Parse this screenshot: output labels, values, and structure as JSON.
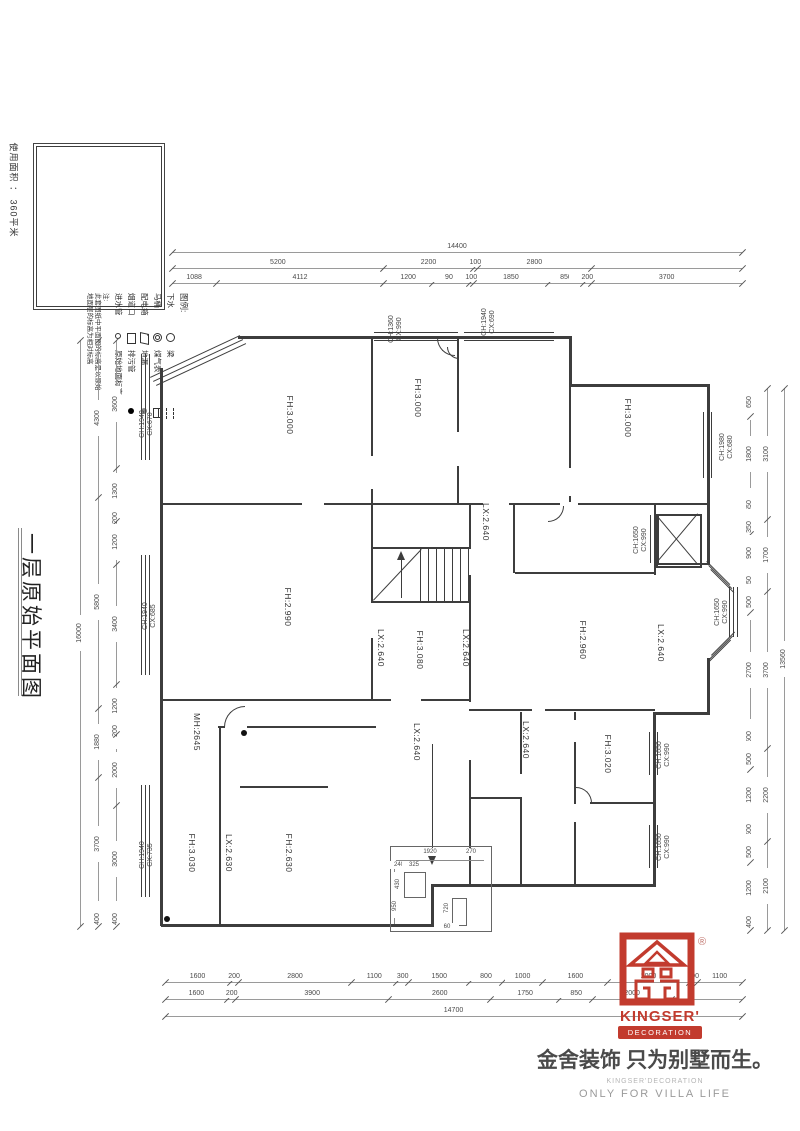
{
  "page": {
    "area_note": "使用面积 ： 360平米",
    "title_vertical": "一层原始平面图"
  },
  "legend": {
    "title": "图例:",
    "items": [
      {
        "label": "下水",
        "symbol": "circle"
      },
      {
        "label": "马桶",
        "symbol": "double-circle"
      },
      {
        "label": "配电箱",
        "symbol": "panel"
      },
      {
        "label": "烟道口",
        "symbol": "flue"
      },
      {
        "label": "进水管",
        "symbol": "small-circle"
      },
      {
        "label": "梁",
        "symbol": "beam"
      },
      {
        "label": "煤气表",
        "symbol": "gas-meter"
      },
      {
        "label": "地漏",
        "symbol": "floor-drain"
      },
      {
        "label": "排污管",
        "symbol": "sewage"
      },
      {
        "label": "原始地面标高",
        "symbol": "elevation"
      }
    ],
    "note_prefix": "注:",
    "note_lines": [
      "此套图纸中平面图的标高是以原始",
      "地面层的标高为相对标高"
    ]
  },
  "plan": {
    "room_labels": [
      {
        "t": "FH:3.000",
        "x": 290,
        "y": 415
      },
      {
        "t": "FH:3.000",
        "x": 418,
        "y": 398
      },
      {
        "t": "FH:3.000",
        "x": 628,
        "y": 418
      },
      {
        "t": "FH:2.990",
        "x": 288,
        "y": 607
      },
      {
        "t": "FH:3.080",
        "x": 420,
        "y": 650
      },
      {
        "t": "LX:2.640",
        "x": 381,
        "y": 648
      },
      {
        "t": "LX:2.640",
        "x": 466,
        "y": 648
      },
      {
        "t": "LX:2.640",
        "x": 486,
        "y": 522
      },
      {
        "t": "FH:2.960",
        "x": 583,
        "y": 640
      },
      {
        "t": "LX:2.640",
        "x": 661,
        "y": 643
      },
      {
        "t": "LX:2.640",
        "x": 417,
        "y": 742
      },
      {
        "t": "LX:2.640",
        "x": 526,
        "y": 740
      },
      {
        "t": "FH:3.020",
        "x": 608,
        "y": 754
      },
      {
        "t": "MH:2645",
        "x": 197,
        "y": 732
      },
      {
        "t": "FH:3.030",
        "x": 192,
        "y": 853
      },
      {
        "t": "LX:2.630",
        "x": 229,
        "y": 853
      },
      {
        "t": "FH:2.630",
        "x": 289,
        "y": 853
      }
    ],
    "window_labels": [
      {
        "l1": "CH:1940",
        "l2": "CX:670",
        "x": 147,
        "y": 424
      },
      {
        "l1": "CH:1940",
        "l2": "CX:685",
        "x": 150,
        "y": 616
      },
      {
        "l1": "CH:1940",
        "l2": "CX:735",
        "x": 147,
        "y": 855
      },
      {
        "l1": "CH:1360",
        "l2": "CX:990",
        "x": 396,
        "y": 329
      },
      {
        "l1": "CH:1940",
        "l2": "CX:690",
        "x": 489,
        "y": 322
      },
      {
        "l1": "CH:1980",
        "l2": "CX:680",
        "x": 727,
        "y": 447
      },
      {
        "l1": "CH:1650",
        "l2": "CX:990",
        "x": 641,
        "y": 540
      },
      {
        "l1": "CH:1650",
        "l2": "CX:990",
        "x": 722,
        "y": 612
      },
      {
        "l1": "CH:1650",
        "l2": "CX:990",
        "x": 664,
        "y": 755
      },
      {
        "l1": "CH:1650",
        "l2": "CX:990",
        "x": 664,
        "y": 847
      }
    ],
    "porch_dims": [
      {
        "t": "1920",
        "x": 430,
        "y": 852,
        "r": 0
      },
      {
        "t": "270",
        "x": 471,
        "y": 852,
        "r": 0
      },
      {
        "t": "240",
        "x": 399,
        "y": 865,
        "r": 0
      },
      {
        "t": "325",
        "x": 414,
        "y": 865,
        "r": 0
      },
      {
        "t": "430",
        "x": 398,
        "y": 884,
        "r": 1
      },
      {
        "t": "950",
        "x": 395,
        "y": 906,
        "r": 1
      },
      {
        "t": "720",
        "x": 447,
        "y": 908,
        "r": 1
      },
      {
        "t": "60",
        "x": 447,
        "y": 927,
        "r": 0
      }
    ]
  },
  "dims": {
    "top": {
      "total": "14400",
      "row2": [
        {
          "t": "5200",
          "w": 5200
        },
        {
          "t": "2200",
          "w": 2200
        },
        {
          "t": "100",
          "w": 100
        },
        {
          "t": "2800",
          "w": 2800
        },
        {
          "t": "",
          "w": 3700
        }
      ],
      "row3": [
        {
          "t": "1088",
          "w": 1088
        },
        {
          "t": "4112",
          "w": 4112
        },
        {
          "t": "1200",
          "w": 1200
        },
        {
          "t": "900",
          "w": 900
        },
        {
          "t": "100",
          "w": 100
        },
        {
          "t": "1850",
          "w": 1850
        },
        {
          "t": "850",
          "w": 850
        },
        {
          "t": "200",
          "w": 200
        },
        {
          "t": "3700",
          "w": 3700
        }
      ]
    },
    "bottom": {
      "total": "14700",
      "row1": [
        {
          "t": "1600",
          "w": 1600
        },
        {
          "t": "200",
          "w": 200
        },
        {
          "t": "2800",
          "w": 2800
        },
        {
          "t": "1100",
          "w": 1100
        },
        {
          "t": "300",
          "w": 300
        },
        {
          "t": "1500",
          "w": 1500
        },
        {
          "t": "800",
          "w": 800
        },
        {
          "t": "1000",
          "w": 1000
        },
        {
          "t": "1600",
          "w": 1600
        },
        {
          "t": "2000",
          "w": 2000
        },
        {
          "t": "200",
          "w": 200
        },
        {
          "t": "1100",
          "w": 1100
        }
      ],
      "row2": [
        {
          "t": "1600",
          "w": 1600
        },
        {
          "t": "200",
          "w": 200
        },
        {
          "t": "3900",
          "w": 3900
        },
        {
          "t": "2600",
          "w": 2600
        },
        {
          "t": "1750",
          "w": 1750
        },
        {
          "t": "850",
          "w": 850
        },
        {
          "t": "2000",
          "w": 2000
        },
        {
          "t": "",
          "w": 1800
        }
      ]
    },
    "left": {
      "total": "16000",
      "groups": [
        {
          "t": "4300",
          "w": 4300
        },
        {
          "t": "5800",
          "w": 5800
        },
        {
          "t": "1880",
          "w": 1880
        },
        {
          "t": "3700",
          "w": 3700
        },
        {
          "t": "400",
          "w": 400
        }
      ],
      "segments": [
        {
          "t": "3600",
          "w": 3600
        },
        {
          "t": "1300",
          "w": 1300
        },
        {
          "t": "200",
          "w": 200
        },
        {
          "t": "1200",
          "w": 1200
        },
        {
          "t": "3400",
          "w": 3400
        },
        {
          "t": "1200",
          "w": 1200
        },
        {
          "t": "200",
          "w": 200
        },
        {
          "t": "2000",
          "w": 2000
        },
        {
          "t": "3000",
          "w": 3000
        },
        {
          "t": "400",
          "w": 400
        }
      ]
    },
    "right": {
      "total": "13560",
      "groups": [
        {
          "t": "3100",
          "w": 3100
        },
        {
          "t": "1700",
          "w": 1700
        },
        {
          "t": "3700",
          "w": 3700
        },
        {
          "t": "2200",
          "w": 2200
        },
        {
          "t": "2100",
          "w": 2100
        }
      ],
      "segments": [
        {
          "t": "650",
          "w": 650
        },
        {
          "t": "1800",
          "w": 1800
        },
        {
          "t": "650",
          "w": 650
        },
        {
          "t": "350",
          "w": 350
        },
        {
          "t": "900",
          "w": 900
        },
        {
          "t": "450",
          "w": 450
        },
        {
          "t": "500",
          "w": 500
        },
        {
          "t": "2700",
          "w": 2700
        },
        {
          "t": "500",
          "w": 500
        },
        {
          "t": "500",
          "w": 500
        },
        {
          "t": "1200",
          "w": 1200
        },
        {
          "t": "500",
          "w": 500
        },
        {
          "t": "500",
          "w": 500
        },
        {
          "t": "1200",
          "w": 1200
        },
        {
          "t": "400",
          "w": 400
        }
      ]
    }
  },
  "brand": {
    "reg": "®",
    "logo_text": "KINGSER'",
    "logo_sub": "DECORATION",
    "tagline": "金舍装饰 只为别墅而生。",
    "foot1": "KINGSER'DECORATION",
    "foot2": "ONLY FOR VILLA LIFE",
    "red": "#c23b2e"
  }
}
